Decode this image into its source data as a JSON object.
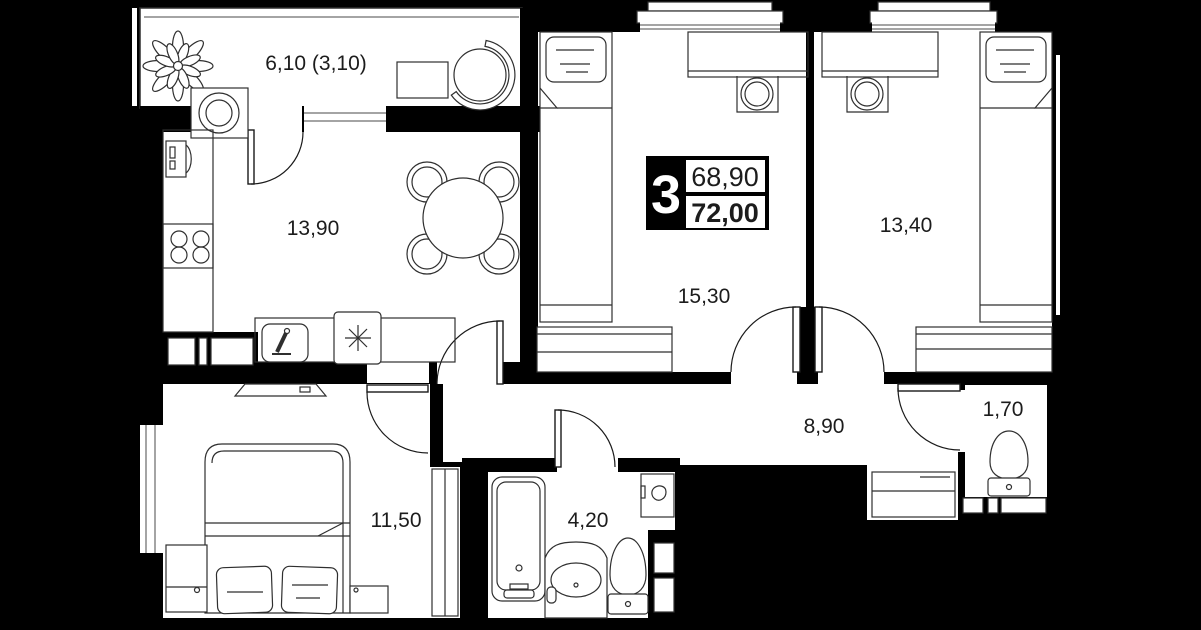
{
  "plan": {
    "title": "apartment-floor-plan",
    "badge": {
      "rooms_count": "3",
      "living_area": "68,90",
      "total_area": "72,00"
    },
    "rooms": [
      {
        "id": "balcony",
        "area_label": "6,10 (3,10)"
      },
      {
        "id": "kitchen-living",
        "area_label": "13,90"
      },
      {
        "id": "bedroom-top-middle",
        "area_label": "15,30"
      },
      {
        "id": "bedroom-top-right",
        "area_label": "13,40"
      },
      {
        "id": "bedroom-bottom-left",
        "area_label": "11,50"
      },
      {
        "id": "bathroom",
        "area_label": "4,20"
      },
      {
        "id": "hallway",
        "area_label": "8,90"
      },
      {
        "id": "wc",
        "area_label": "1,70"
      }
    ],
    "colors": {
      "background": "#000000",
      "room_fill": "#ffffff",
      "line": "#2f2f2f",
      "label_text": "#1c1c1c",
      "badge_fill": "#000000",
      "badge_text": "#ffffff"
    }
  }
}
